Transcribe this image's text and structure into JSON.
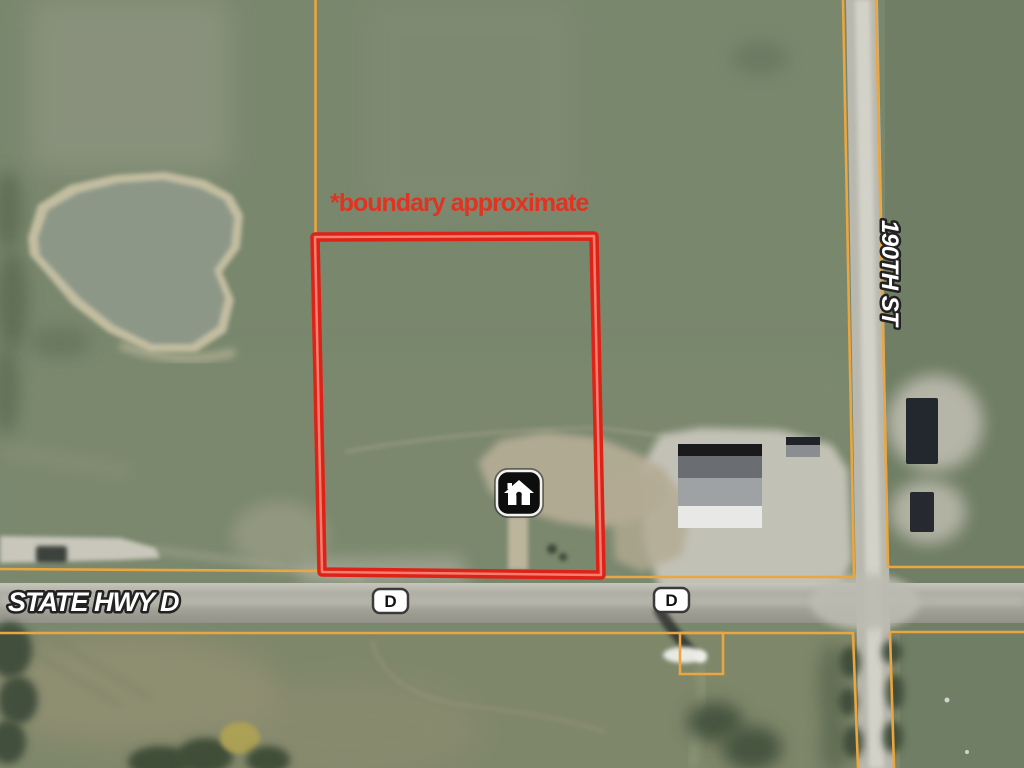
{
  "map": {
    "view": "aerial-satellite-property-listing",
    "boundary_note": "*boundary approximate",
    "roads": {
      "highway_label": "STATE HWY D",
      "street_label": "190TH ST",
      "route_shield_west": "D",
      "route_shield_east": "D"
    },
    "marker": {
      "icon": "home-icon",
      "style": "black-rounded-square"
    },
    "colors": {
      "boundary_red": "#dc2318",
      "note_red": "#e23322",
      "parcel_orange": "#eaa640",
      "field_green": "#79876d",
      "road_gray": "#aeada3",
      "pond_gray_green": "#8c9787",
      "label_white": "#ffffff",
      "label_outline": "#222222"
    }
  }
}
